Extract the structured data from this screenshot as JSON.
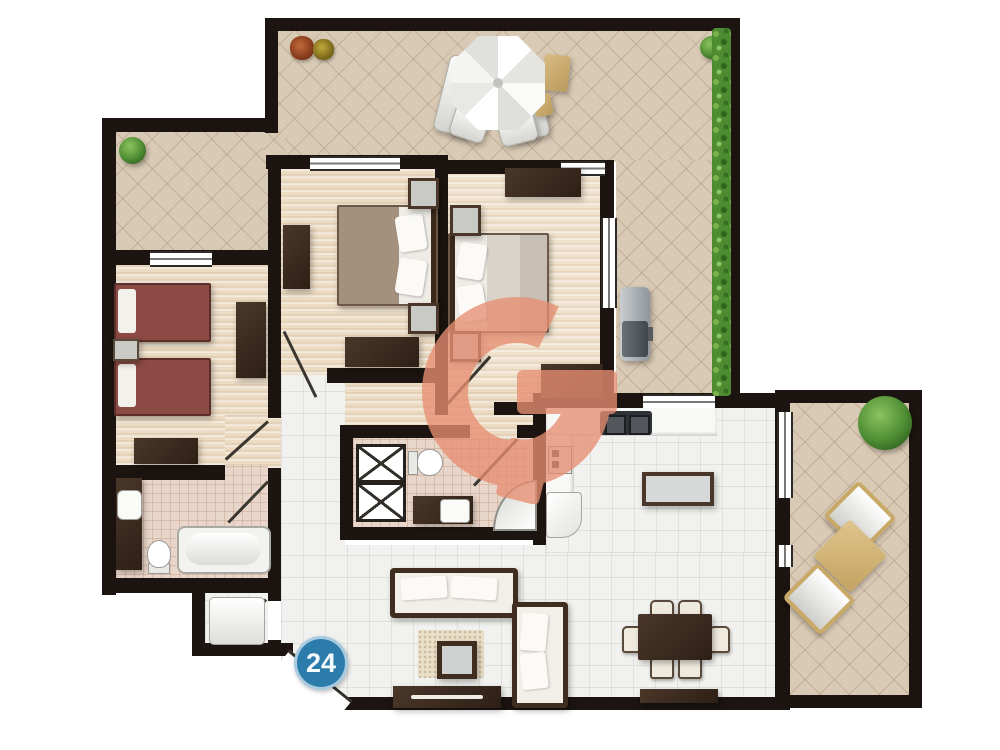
{
  "badge": {
    "value": "24"
  },
  "colors": {
    "wall": "#1b1410",
    "terrace": "#d9cab5",
    "terrace_line": "#b79f83",
    "white_tile": "#f1f1ef",
    "wood": "#ecdcc4",
    "bath_tile": "#e9d6ca",
    "dark_wood": "#3b2a1c",
    "maroon_bed": "#8c4a44",
    "grey_bed": "#d9d3ca",
    "brown_bed": "#94816f",
    "salmon_watermark": "#e78f72",
    "badge": "#2b7cab",
    "hedge": "#4d8c33",
    "plant": "#4d8c33",
    "tan": "#c9a968",
    "counter": "#f8f8f6"
  },
  "icons": [
    "umbrella-icon",
    "sun-lounger-icon",
    "side-table-icon",
    "potted-plant-icon",
    "hedge-icon",
    "bbq-grill-icon",
    "double-bed-icon",
    "single-bed-icon",
    "nightstand-icon",
    "wardrobe-icon",
    "dresser-icon",
    "bathtub-icon",
    "toilet-icon",
    "sink-icon",
    "shower-icon",
    "corner-shower-icon",
    "washing-machine-icon",
    "kitchen-counter-icon",
    "stove-icon",
    "fridge-icon",
    "kitchen-island-icon",
    "dining-table-icon",
    "chair-icon",
    "sofa-icon",
    "coffee-table-icon",
    "rug-icon",
    "tv-stand-icon",
    "patio-chair-icon",
    "patio-table-icon",
    "door-icon",
    "window-icon",
    "watermark-g-icon"
  ]
}
